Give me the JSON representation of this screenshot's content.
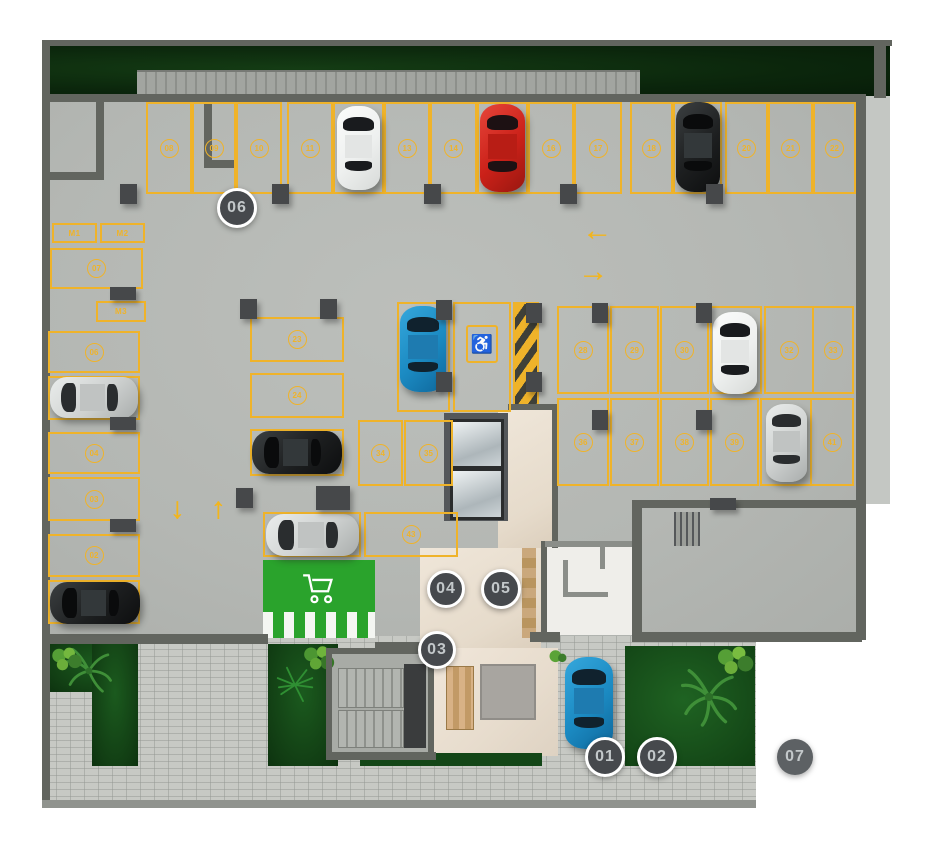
{
  "icons": {
    "accessible": "♿",
    "cart": "cart-icon"
  },
  "colors": {
    "line_yellow": "#efb32a",
    "floor": "#b6b9b5",
    "grass": "#0b260c",
    "green_zone": "#2aa32c",
    "marker_bg": "#46494d",
    "marker_ring": "#ffffff",
    "wall": "#62655f",
    "paver": "#c7c9c4",
    "lobby": "#e9dfd2"
  },
  "parking": {
    "spots": [
      {
        "n": "08",
        "x": 146,
        "y": 102,
        "w": 46,
        "h": 92
      },
      {
        "n": "09",
        "x": 192,
        "y": 102,
        "w": 44,
        "h": 92
      },
      {
        "n": "10",
        "x": 236,
        "y": 102,
        "w": 46,
        "h": 92
      },
      {
        "n": "11",
        "x": 287,
        "y": 102,
        "w": 46,
        "h": 92
      },
      {
        "n": null,
        "x": 333,
        "y": 102,
        "w": 51,
        "h": 92
      },
      {
        "n": "13",
        "x": 384,
        "y": 102,
        "w": 46,
        "h": 92
      },
      {
        "n": "14",
        "x": 430,
        "y": 102,
        "w": 47,
        "h": 92
      },
      {
        "n": null,
        "x": 477,
        "y": 102,
        "w": 51,
        "h": 92
      },
      {
        "n": "16",
        "x": 528,
        "y": 102,
        "w": 46,
        "h": 92
      },
      {
        "n": "17",
        "x": 574,
        "y": 102,
        "w": 48,
        "h": 92
      },
      {
        "n": "18",
        "x": 630,
        "y": 102,
        "w": 43,
        "h": 92
      },
      {
        "n": null,
        "x": 673,
        "y": 102,
        "w": 49,
        "h": 92
      },
      {
        "n": "20",
        "x": 725,
        "y": 102,
        "w": 43,
        "h": 92
      },
      {
        "n": "21",
        "x": 768,
        "y": 102,
        "w": 45,
        "h": 92
      },
      {
        "n": "22",
        "x": 813,
        "y": 102,
        "w": 43,
        "h": 92
      },
      {
        "n": "M1",
        "plain": true,
        "x": 52,
        "y": 223,
        "w": 45,
        "h": 20
      },
      {
        "n": "M2",
        "plain": true,
        "x": 100,
        "y": 223,
        "w": 45,
        "h": 20
      },
      {
        "n": "07",
        "x": 50,
        "y": 248,
        "w": 93,
        "h": 41
      },
      {
        "n": "M3",
        "plain": true,
        "x": 96,
        "y": 301,
        "w": 50,
        "h": 21
      },
      {
        "n": "06",
        "x": 48,
        "y": 331,
        "w": 92,
        "h": 42
      },
      {
        "n": null,
        "x": 48,
        "y": 376,
        "w": 92,
        "h": 44
      },
      {
        "n": "04",
        "x": 48,
        "y": 432,
        "w": 92,
        "h": 42
      },
      {
        "n": "03",
        "x": 48,
        "y": 477,
        "w": 92,
        "h": 44
      },
      {
        "n": "02",
        "x": 48,
        "y": 534,
        "w": 92,
        "h": 43
      },
      {
        "n": null,
        "x": 48,
        "y": 580,
        "w": 92,
        "h": 44
      },
      {
        "n": "23",
        "x": 250,
        "y": 317,
        "w": 94,
        "h": 45
      },
      {
        "n": "24",
        "x": 250,
        "y": 373,
        "w": 94,
        "h": 45
      },
      {
        "n": null,
        "x": 250,
        "y": 429,
        "w": 94,
        "h": 47
      },
      {
        "n": null,
        "x": 263,
        "y": 512,
        "w": 98,
        "h": 45
      },
      {
        "n": "43",
        "x": 364,
        "y": 512,
        "w": 94,
        "h": 45
      },
      {
        "n": null,
        "x": 397,
        "y": 302,
        "w": 53,
        "h": 110
      },
      {
        "n": null,
        "acc": true,
        "x": 453,
        "y": 302,
        "w": 58,
        "h": 110
      },
      {
        "n": "34",
        "x": 358,
        "y": 420,
        "w": 45,
        "h": 66
      },
      {
        "n": "35",
        "x": 404,
        "y": 420,
        "w": 49,
        "h": 66
      },
      {
        "n": "28",
        "x": 557,
        "y": 306,
        "w": 52,
        "h": 88
      },
      {
        "n": "29",
        "x": 610,
        "y": 306,
        "w": 49,
        "h": 88
      },
      {
        "n": "30",
        "x": 660,
        "y": 306,
        "w": 49,
        "h": 88
      },
      {
        "n": null,
        "x": 710,
        "y": 306,
        "w": 52,
        "h": 88
      },
      {
        "n": "32",
        "x": 764,
        "y": 306,
        "w": 50,
        "h": 88
      },
      {
        "n": "33",
        "x": 812,
        "y": 306,
        "w": 42,
        "h": 88
      },
      {
        "n": "36",
        "x": 557,
        "y": 398,
        "w": 52,
        "h": 88
      },
      {
        "n": "37",
        "x": 610,
        "y": 398,
        "w": 49,
        "h": 88
      },
      {
        "n": "38",
        "x": 660,
        "y": 398,
        "w": 49,
        "h": 88
      },
      {
        "n": "39",
        "x": 710,
        "y": 398,
        "w": 49,
        "h": 88
      },
      {
        "n": null,
        "x": 760,
        "y": 398,
        "w": 52,
        "h": 88
      },
      {
        "n": "41",
        "x": 810,
        "y": 398,
        "w": 44,
        "h": 88
      }
    ]
  },
  "cars": [
    {
      "c": "white",
      "o": "v",
      "x": 337,
      "y": 106,
      "w": 43,
      "h": 84
    },
    {
      "c": "red",
      "o": "v",
      "x": 480,
      "y": 104,
      "w": 45,
      "h": 88
    },
    {
      "c": "black",
      "o": "v",
      "x": 676,
      "y": 102,
      "w": 44,
      "h": 90
    },
    {
      "c": "blue",
      "o": "v",
      "x": 400,
      "y": 306,
      "w": 46,
      "h": 86
    },
    {
      "c": "white",
      "o": "v",
      "x": 713,
      "y": 312,
      "w": 44,
      "h": 82
    },
    {
      "c": "silver",
      "o": "v",
      "x": 766,
      "y": 404,
      "w": 41,
      "h": 78
    },
    {
      "c": "silver",
      "o": "h",
      "x": 50,
      "y": 377,
      "w": 88,
      "h": 41
    },
    {
      "c": "black",
      "o": "h",
      "x": 50,
      "y": 582,
      "w": 90,
      "h": 42
    },
    {
      "c": "black",
      "o": "h",
      "x": 252,
      "y": 431,
      "w": 90,
      "h": 43
    },
    {
      "c": "silver",
      "o": "h",
      "x": 266,
      "y": 514,
      "w": 93,
      "h": 42
    },
    {
      "c": "blue",
      "o": "v",
      "x": 565,
      "y": 657,
      "w": 48,
      "h": 92
    }
  ],
  "car_colors": {
    "white": {
      "hi": "#fbfcfb",
      "base": "#eef0ef",
      "lo": "#d7dad8",
      "roof": "#e3e5e4",
      "glass": "#191b1e"
    },
    "red": {
      "hi": "#e6453a",
      "base": "#cb2119",
      "lo": "#991710",
      "roof": "#b81d15",
      "glass": "#1d1113"
    },
    "black": {
      "hi": "#3b3f41",
      "base": "#1d1f20",
      "lo": "#0d0e0f",
      "roof": "#33383a",
      "glass": "#0a0b0c"
    },
    "blue": {
      "hi": "#35a7dc",
      "base": "#1b8ac2",
      "lo": "#0f679b",
      "roof": "#1e7bb0",
      "glass": "#10222e"
    },
    "silver": {
      "hi": "#eaedec",
      "base": "#ced1d0",
      "lo": "#a9adac",
      "roof": "#c0c3c2",
      "glass": "#2a2d2f"
    }
  },
  "markers": [
    {
      "label": "01",
      "cx": 605,
      "cy": 757,
      "d": 40,
      "ring": true
    },
    {
      "label": "02",
      "cx": 657,
      "cy": 757,
      "d": 40,
      "ring": true
    },
    {
      "label": "03",
      "cx": 437,
      "cy": 650,
      "d": 38,
      "ring": true
    },
    {
      "label": "04",
      "cx": 446,
      "cy": 589,
      "d": 38,
      "ring": true
    },
    {
      "label": "05",
      "cx": 501,
      "cy": 589,
      "d": 40,
      "ring": true
    },
    {
      "label": "06",
      "cx": 237,
      "cy": 208,
      "d": 40,
      "ring": true
    },
    {
      "label": "07",
      "cx": 795,
      "cy": 757,
      "d": 36,
      "ring": false
    }
  ],
  "arrows": [
    {
      "glyph": "←",
      "x": 597,
      "y": 231
    },
    {
      "glyph": "→",
      "x": 593,
      "y": 272
    },
    {
      "glyph": "↓",
      "x": 177,
      "y": 509
    },
    {
      "glyph": "↑",
      "x": 218,
      "y": 509
    }
  ],
  "structure": {
    "columns": [
      {
        "x": 120,
        "y": 184,
        "w": 17,
        "h": 20
      },
      {
        "x": 272,
        "y": 184,
        "w": 17,
        "h": 20
      },
      {
        "x": 424,
        "y": 184,
        "w": 17,
        "h": 20
      },
      {
        "x": 560,
        "y": 184,
        "w": 17,
        "h": 20
      },
      {
        "x": 706,
        "y": 184,
        "w": 17,
        "h": 20
      },
      {
        "x": 110,
        "y": 287,
        "w": 26,
        "h": 13
      },
      {
        "x": 110,
        "y": 417,
        "w": 26,
        "h": 13
      },
      {
        "x": 110,
        "y": 519,
        "w": 26,
        "h": 13
      },
      {
        "x": 240,
        "y": 299,
        "w": 17,
        "h": 20
      },
      {
        "x": 320,
        "y": 299,
        "w": 17,
        "h": 20
      },
      {
        "x": 436,
        "y": 300,
        "w": 16,
        "h": 20
      },
      {
        "x": 436,
        "y": 372,
        "w": 16,
        "h": 20
      },
      {
        "x": 526,
        "y": 303,
        "w": 16,
        "h": 20
      },
      {
        "x": 526,
        "y": 372,
        "w": 16,
        "h": 20
      },
      {
        "x": 592,
        "y": 303,
        "w": 16,
        "h": 20
      },
      {
        "x": 696,
        "y": 303,
        "w": 16,
        "h": 20
      },
      {
        "x": 592,
        "y": 410,
        "w": 16,
        "h": 20
      },
      {
        "x": 696,
        "y": 410,
        "w": 16,
        "h": 20
      },
      {
        "x": 316,
        "y": 486,
        "w": 34,
        "h": 24
      },
      {
        "x": 236,
        "y": 488,
        "w": 17,
        "h": 20
      },
      {
        "x": 710,
        "y": 498,
        "w": 26,
        "h": 12
      }
    ],
    "walls": [
      {
        "x": 42,
        "y": 40,
        "w": 850,
        "h": 6
      },
      {
        "x": 42,
        "y": 40,
        "w": 8,
        "h": 768
      },
      {
        "x": 874,
        "y": 40,
        "w": 12,
        "h": 58
      },
      {
        "x": 48,
        "y": 94,
        "w": 812,
        "h": 8
      },
      {
        "x": 856,
        "y": 94,
        "w": 10,
        "h": 546
      },
      {
        "x": 48,
        "y": 634,
        "w": 220,
        "h": 10
      },
      {
        "x": 375,
        "y": 642,
        "w": 59,
        "h": 8
      },
      {
        "x": 530,
        "y": 632,
        "w": 30,
        "h": 10
      },
      {
        "x": 632,
        "y": 632,
        "w": 112,
        "h": 10
      },
      {
        "x": 744,
        "y": 632,
        "w": 118,
        "h": 10
      },
      {
        "x": 96,
        "y": 96,
        "w": 8,
        "h": 82
      },
      {
        "x": 48,
        "y": 172,
        "w": 56,
        "h": 8
      },
      {
        "x": 204,
        "y": 96,
        "w": 8,
        "h": 72
      },
      {
        "x": 204,
        "y": 160,
        "w": 34,
        "h": 8
      },
      {
        "x": 326,
        "y": 648,
        "w": 108,
        "h": 6
      },
      {
        "x": 326,
        "y": 648,
        "w": 6,
        "h": 112
      },
      {
        "x": 428,
        "y": 648,
        "w": 6,
        "h": 112
      },
      {
        "x": 326,
        "y": 752,
        "w": 110,
        "h": 8
      },
      {
        "x": 508,
        "y": 404,
        "w": 50,
        "h": 6
      },
      {
        "x": 552,
        "y": 406,
        "w": 6,
        "h": 142
      },
      {
        "x": 541,
        "y": 541,
        "w": 6,
        "h": 98
      },
      {
        "x": 545,
        "y": 541,
        "w": 96,
        "h": 6,
        "c": "#8b8e89"
      },
      {
        "x": 632,
        "y": 500,
        "w": 10,
        "h": 140
      },
      {
        "x": 640,
        "y": 500,
        "w": 218,
        "h": 8
      },
      {
        "x": 563,
        "y": 560,
        "w": 5,
        "h": 36,
        "c": "#8b8e89"
      },
      {
        "x": 563,
        "y": 592,
        "w": 45,
        "h": 5,
        "c": "#8b8e89"
      },
      {
        "x": 600,
        "y": 541,
        "w": 5,
        "h": 28,
        "c": "#8b8e89"
      },
      {
        "x": 42,
        "y": 800,
        "w": 714,
        "h": 8,
        "c": "#90938e"
      }
    ]
  }
}
